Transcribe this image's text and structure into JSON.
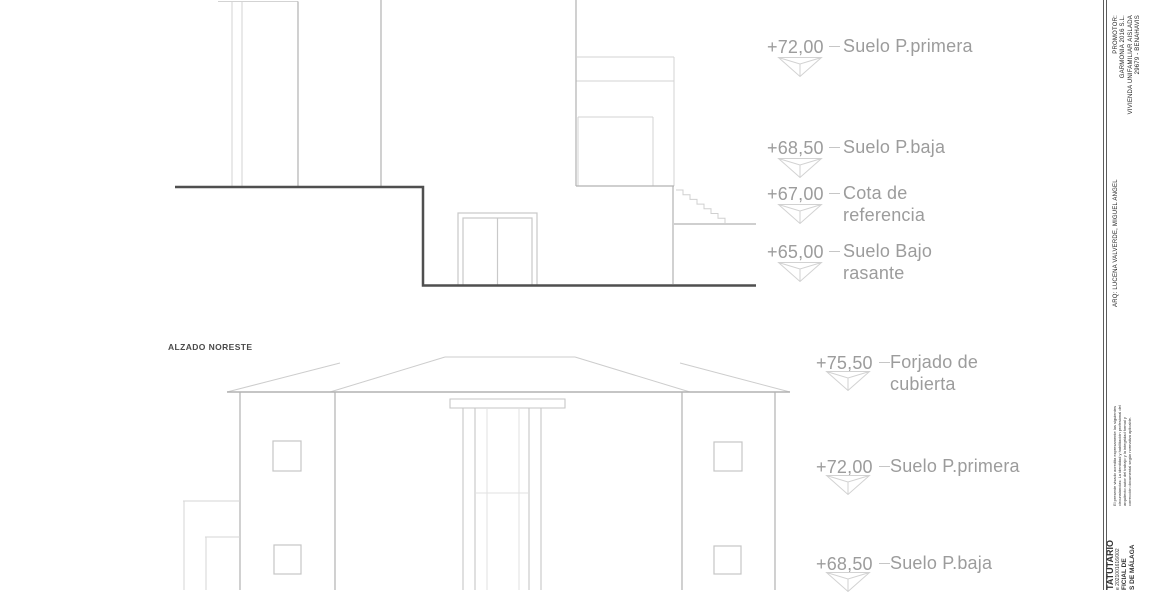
{
  "sheet": {
    "top_elevation": {
      "levels": [
        {
          "value": "+72,00",
          "line1": "Suelo P.primera",
          "line2": ""
        },
        {
          "value": "+68,50",
          "line1": "Suelo P.baja",
          "line2": ""
        },
        {
          "value": "+67,00",
          "line1": "Cota de",
          "line2": "referencia"
        },
        {
          "value": "+65,00",
          "line1": "Suelo Bajo",
          "line2": "rasante"
        }
      ]
    },
    "bottom_elevation": {
      "title": "ALZADO NORESTE",
      "levels": [
        {
          "value": "+75,50",
          "line1": "Forjado de",
          "line2": "cubierta"
        },
        {
          "value": "+72,00",
          "line1": "Suelo P.primera",
          "line2": ""
        },
        {
          "value": "+68,50",
          "line1": "Suelo P.baja",
          "line2": ""
        }
      ]
    },
    "titleblock": {
      "architect": "ARQ: LUCENA VALVERDE, MIGUEL ANGEL",
      "promotor_label": "PROMOTOR:",
      "promotor_lines": [
        "GARMONIA 2016 S.L.",
        "VIVIENDA UNIFAMILIAR AISLADA",
        "29679 - BENAHAVIS"
      ],
      "visado_note_lines": [
        "El presente visado acredita expresamente las siguientes",
        "circunstancias: La identidad y habilitación profesional del",
        "arquitecto autor del trabajo y la integridad formal y",
        "corrección documental según normativa aplicable."
      ],
      "stamp_lines": [
        "TATUTARIO",
        "e 2021001616/002",
        "FICIAL DE",
        "S DE MÁLAGA"
      ]
    },
    "colors": {
      "annotation_text": "#9c9c9c",
      "drawing_line_light": "#d3d3d3",
      "drawing_line_medium": "#b2b2b2",
      "ground_line": "#4f4f4f",
      "title_text": "#4a4a4a"
    }
  }
}
